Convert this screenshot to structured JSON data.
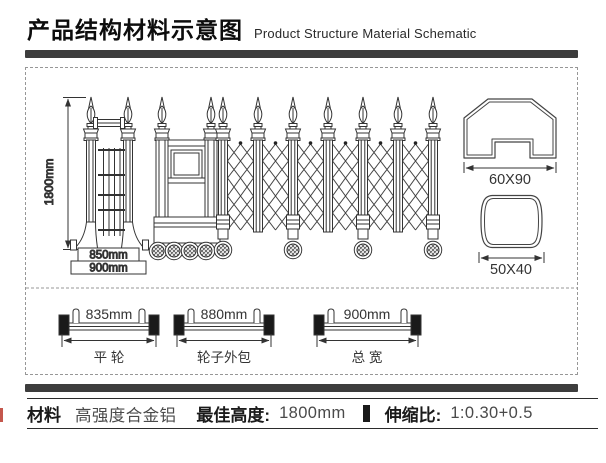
{
  "header": {
    "title_cn": "产品结构材料示意图",
    "title_en": "Product Structure Material Schematic"
  },
  "drawing": {
    "gate_height": "1800mm",
    "base_inner_width": "850mm",
    "base_outer_width": "900mm",
    "profile_main": "60X90",
    "profile_cross": "50X40",
    "axles": [
      {
        "dim": "835mm",
        "label": "平 轮"
      },
      {
        "dim": "880mm",
        "label": "轮子外包"
      },
      {
        "dim": "900mm",
        "label": "总 宽"
      }
    ]
  },
  "footer": {
    "material_label": "材料",
    "material_value": "高强度合金铝",
    "best_height_label": "最佳高度:",
    "best_height_value": "1800mm",
    "ratio_label": "伸缩比:",
    "ratio_value": "1:0.30+0.5"
  },
  "colors": {
    "bar": "#3d3d3d",
    "accent_red": "#c4574d",
    "line": "#333333"
  }
}
